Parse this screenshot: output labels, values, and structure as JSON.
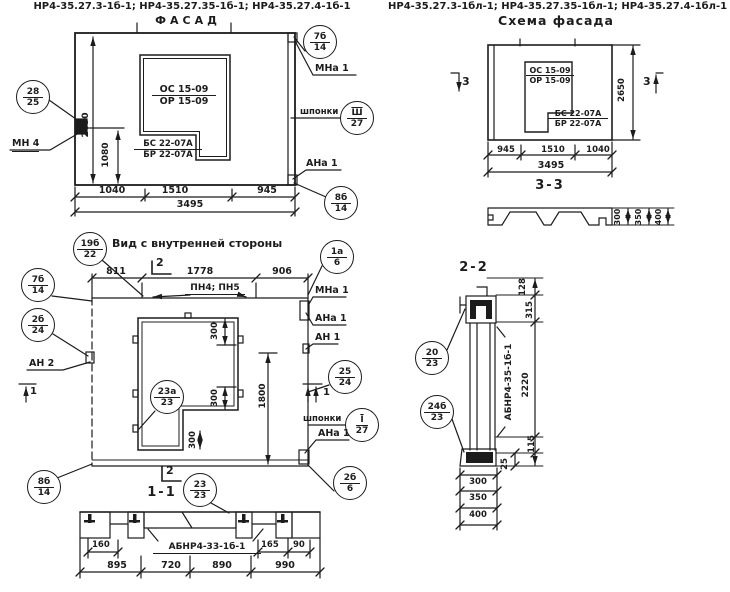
{
  "headers": {
    "left": "НР4-35.27.3-1б-1; НР4-35.27.35-1б-1; НР4-35.27.4-1б-1",
    "right": "НР4-35.27.3-1бл-1; НР4-35.27.35-1бл-1; НР4-35.27.4-1бл-1"
  },
  "facade": {
    "title": "ФАСАД",
    "window_top": "ОС 15-09",
    "window_bot": "ОР 15-09",
    "block_top": "БС 22-07А",
    "block_bot": "БР 22-07А",
    "mn4": "МН 4",
    "mna1": "МНа 1",
    "shponki": "шпонки",
    "ana1": "АНа 1",
    "co_left_n": "28",
    "co_left_s": "25",
    "co_tr_n": "7б",
    "co_tr_s": "14",
    "co_sh_n": "Ш",
    "co_sh_s": "27",
    "co_br_n": "8б",
    "co_br_s": "14",
    "dim_h": "2650",
    "dim_sill": "1080",
    "dim_w1": "1040",
    "dim_w2": "1510",
    "dim_w3": "945",
    "dim_total": "3495"
  },
  "inner": {
    "title": "Вид с внутренней стороны",
    "co_t_n": "19б",
    "co_t_s": "22",
    "pn": "ПН4; ПН5",
    "mark2": "2",
    "mark1": "1",
    "co_tr_n": "1а",
    "co_tr_s": "6",
    "mna1": "МНа 1",
    "ana1": "АНа 1",
    "an1": "АН 1",
    "an2": "АН 2",
    "co_25_n": "25",
    "co_25_s": "24",
    "shponki": "шпонки",
    "co_sh_n": "I",
    "co_sh_s": "27",
    "co_br_n": "2б",
    "co_br_s": "6",
    "co_tl_n": "7б",
    "co_tl_s": "14",
    "co_l_n": "2б",
    "co_l_s": "24",
    "co_bl_n": "8б",
    "co_bl_s": "14",
    "co_op_n": "23а",
    "co_op_s": "23",
    "dim_w1": "811",
    "dim_w2": "1778",
    "dim_w3": "906",
    "dim_300": "300",
    "dim_h1800": "1800"
  },
  "sec11": {
    "title": "1-1",
    "mark2": "2",
    "co_n": "23",
    "co_s": "23",
    "label": "АБНР4-33-1б-1",
    "d160": "160",
    "d165": "165",
    "d90": "90",
    "w1": "895",
    "w2": "720",
    "w3": "890",
    "w4": "990"
  },
  "schema": {
    "title": "Схема фасада",
    "window_top": "ОС 15-09",
    "window_bot": "ОР 15-09",
    "block_top": "БС 22-07А",
    "block_bot": "БР 22-07А",
    "mark3": "3",
    "dim_h": "2650",
    "dim_w1": "945",
    "dim_w2": "1510",
    "dim_w3": "1040",
    "dim_total": "3495"
  },
  "sec33": {
    "title": "3-3",
    "t1": "300",
    "t2": "350",
    "t3": "400"
  },
  "sec22": {
    "title": "2-2",
    "label": "АБНР4-35-1б-1",
    "co1_n": "20",
    "co1_s": "23",
    "co2_n": "24б",
    "co2_s": "23",
    "d128": "128",
    "d315": "315",
    "d2220": "2220",
    "d115": "115",
    "d25": "25",
    "t1": "300",
    "t2": "350",
    "t3": "400"
  }
}
